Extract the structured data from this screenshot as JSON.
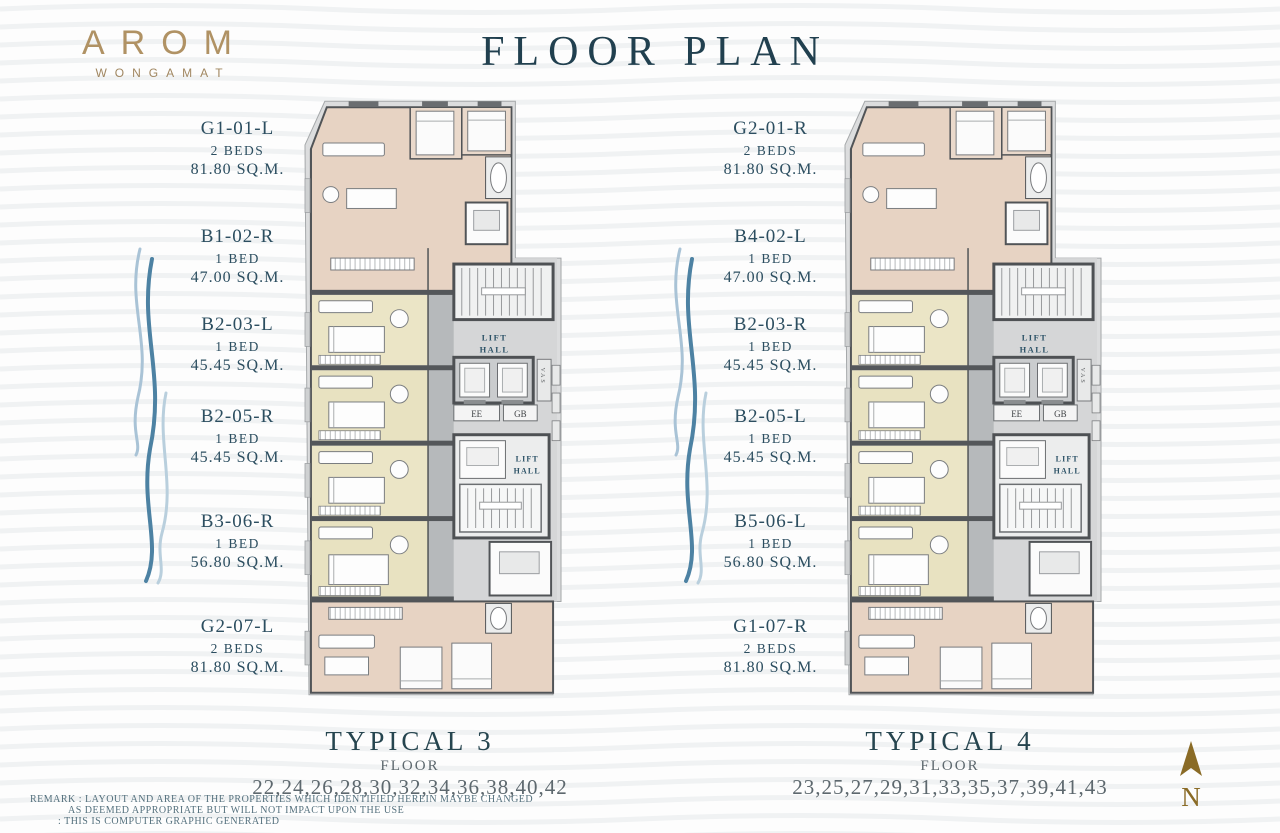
{
  "header": {
    "brand": "AROM",
    "brand_sub": "WONGAMAT",
    "title": "FLOOR PLAN"
  },
  "plans": [
    {
      "name": "TYPICAL 3",
      "floors_label": "FLOOR",
      "floors": "22,24,26,28,30,32,34,36,38,40,42",
      "units": [
        {
          "code": "G1-01-L",
          "beds": "2 BEDS",
          "area": "81.80 SQ.M."
        },
        {
          "code": "B1-02-R",
          "beds": "1 BED",
          "area": "47.00 SQ.M."
        },
        {
          "code": "B2-03-L",
          "beds": "1 BED",
          "area": "45.45 SQ.M."
        },
        {
          "code": "B2-05-R",
          "beds": "1 BED",
          "area": "45.45 SQ.M."
        },
        {
          "code": "B3-06-R",
          "beds": "1 BED",
          "area": "56.80 SQ.M."
        },
        {
          "code": "G2-07-L",
          "beds": "2 BEDS",
          "area": "81.80 SQ.M."
        }
      ]
    },
    {
      "name": "TYPICAL 4",
      "floors_label": "FLOOR",
      "floors": "23,25,27,29,31,33,35,37,39,41,43",
      "units": [
        {
          "code": "G2-01-R",
          "beds": "2 BEDS",
          "area": "81.80 SQ.M."
        },
        {
          "code": "B4-02-L",
          "beds": "1 BED",
          "area": "47.00 SQ.M."
        },
        {
          "code": "B2-03-R",
          "beds": "1 BED",
          "area": "45.45 SQ.M."
        },
        {
          "code": "B2-05-L",
          "beds": "1 BED",
          "area": "45.45 SQ.M."
        },
        {
          "code": "B5-06-L",
          "beds": "1 BED",
          "area": "56.80 SQ.M."
        },
        {
          "code": "G1-07-R",
          "beds": "2 BEDS",
          "area": "81.80 SQ.M."
        }
      ]
    }
  ],
  "plan_labels": {
    "lift_hall_line1": "LIFT",
    "lift_hall_line2": "HALL",
    "ee": "EE",
    "gb": "GB",
    "riser": "VAS"
  },
  "remark": {
    "line1": "REMARK : LAYOUT AND AREA OF THE PROPERTIES WHICH IDENTIFIED HEREIN MAYBE CHANGED",
    "line2": "AS DEEMED APPROPRIATE BUT WILL NOT IMPACT UPON THE USE",
    "line3": ": THIS IS COMPUTER GRAPHIC GENERATED"
  },
  "compass": {
    "north": "N"
  },
  "colors": {
    "accent_teal": "#2c4e60",
    "gold": "#b09264",
    "unit_pink": "#e7d3c3",
    "unit_cream": "#ebe5c6",
    "core_gray": "#6a6d70",
    "wave_blue": "#4d82a3"
  }
}
